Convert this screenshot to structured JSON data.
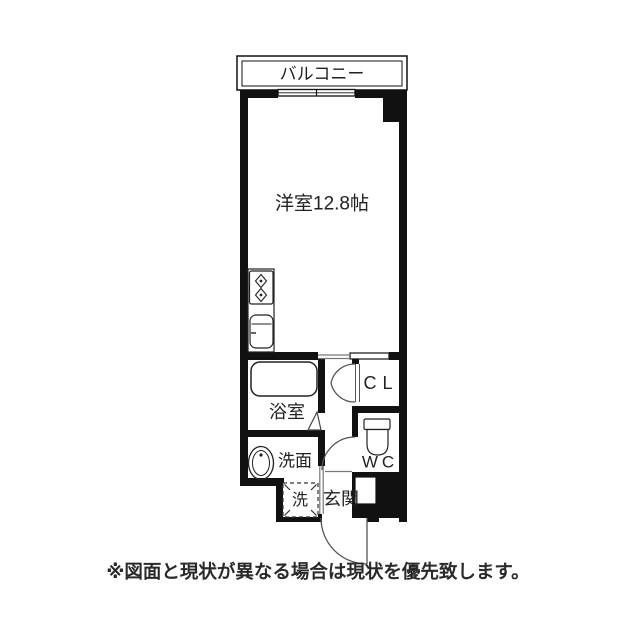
{
  "floorplan": {
    "labels": {
      "balcony": "バルコニー",
      "main_room": "洋室12.8帖",
      "bathroom": "浴室",
      "washroom": "洗面",
      "closet": "CL",
      "toilet": "WC",
      "entrance": "玄関",
      "laundry": "洗"
    },
    "disclaimer": "※図面と現状が異なる場合は現状を優先致します。",
    "colors": {
      "wall": "#111111",
      "fixture_line": "#222222",
      "door_line": "#555555",
      "thin_line": "#777777",
      "text": "#222222",
      "background": "#ffffff"
    }
  }
}
